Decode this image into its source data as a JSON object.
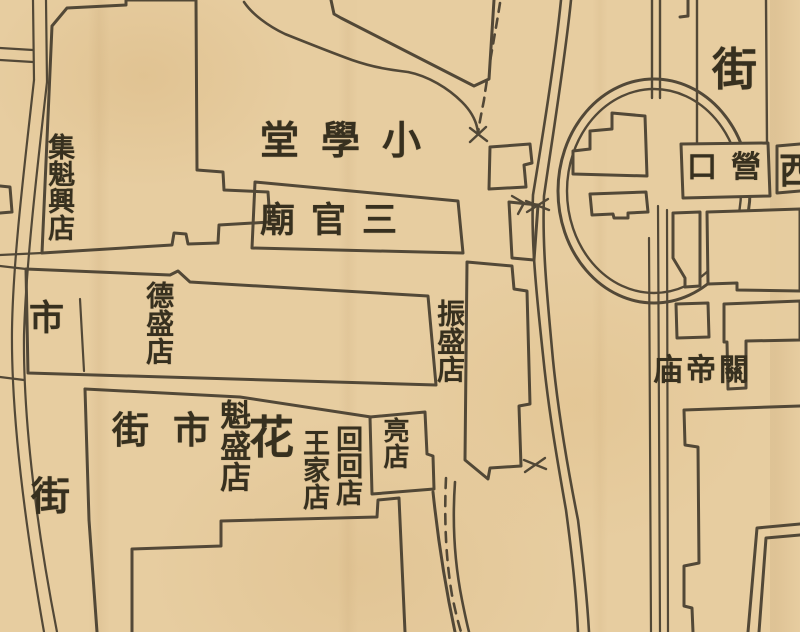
{
  "map": {
    "kind": "historical hand-drawn Chinese town plat map",
    "colors": {
      "paper": "#e7cda0",
      "ink": "#3f382b",
      "text": "#37301f"
    },
    "labels": {
      "ji_kui_xing_dian": {
        "display": "集魁興店",
        "reading": "集魁興店",
        "type": "shop"
      },
      "xiao_xue_tang": {
        "display": "堂學小",
        "reading": "小學堂",
        "type": "school"
      },
      "san_guan_miao": {
        "display": "廟官三",
        "reading": "三官廟",
        "type": "temple"
      },
      "de_sheng_dian": {
        "display": "德盛店",
        "reading": "德盛店",
        "type": "shop"
      },
      "zhen_sheng_dian": {
        "display": "振盛店",
        "reading": "振盛店",
        "type": "shop"
      },
      "shi_upper": {
        "display": "市",
        "reading": "市",
        "type": "street-name-part"
      },
      "jie_lower": {
        "display": "街",
        "reading": "街",
        "type": "street-name-part"
      },
      "shi_jie_row": {
        "display": "街市",
        "reading": "市街",
        "type": "street-name"
      },
      "hua": {
        "display": "花",
        "reading": "花",
        "type": "shop-name-part"
      },
      "kui_sheng_dian": {
        "display": "魁盛店",
        "reading": "花魁盛店",
        "type": "shop"
      },
      "wang_jia_dian": {
        "display": "王家店",
        "reading": "王家店",
        "type": "shop"
      },
      "hui_hui_dian": {
        "display": "回回店",
        "reading": "回回店",
        "type": "shop"
      },
      "liang_dian": {
        "display": "亮店",
        "reading": "亮店",
        "type": "shop"
      },
      "jie_top_right": {
        "display": "街",
        "reading": "街",
        "type": "street-name-part"
      },
      "ying_kou": {
        "display": "口營",
        "reading": "營口",
        "type": "place"
      },
      "xi": {
        "display": "西",
        "reading": "西",
        "type": "label-partial"
      },
      "guan_di_miao": {
        "display": "庙帝關",
        "reading": "關帝廟",
        "type": "temple"
      }
    }
  }
}
